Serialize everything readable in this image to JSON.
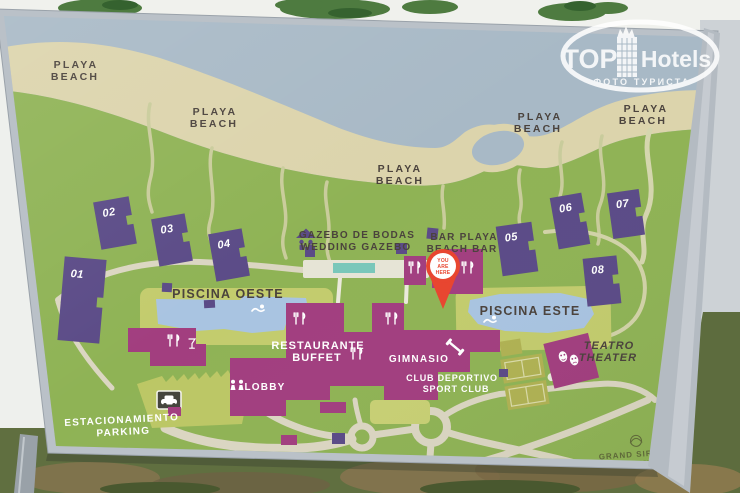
{
  "watermark": {
    "top_word": "TOP",
    "hotels_word": "Hotels",
    "subtitle": "ФОТО ТУРИСТА"
  },
  "brand": {
    "name": "GRAND SIRENIS",
    "tagline": "HOTELS & RESORTS",
    "stars": "★★★★★"
  },
  "map": {
    "beach_line1": "PLAYA",
    "beach_line2": "BEACH",
    "buildings": [
      "01",
      "02",
      "03",
      "04",
      "05",
      "06",
      "07",
      "08"
    ],
    "gazebo_line1": "GAZEBO DE BODAS",
    "gazebo_line2": "WEDDING GAZEBO",
    "bar_line1": "BAR PLAYA",
    "bar_line2": "BEACH BAR",
    "you_line1": "YOU",
    "you_line2": "ARE",
    "you_line3": "HERE",
    "piscina_oeste": "PISCINA OESTE",
    "piscina_este": "PISCINA ESTE",
    "restaurante_line1": "RESTAURANTE",
    "restaurante_line2": "BUFFET",
    "gimnasio": "GIMNASIO",
    "club_line1": "CLUB DEPORTIVO",
    "club_line2": "SPORT CLUB",
    "lobby": "LOBBY",
    "parking_line1": "ESTACIONAMIENTO",
    "parking_line2": "PARKING",
    "teatro_line1": "TEATRO",
    "teatro_line2": "THEATER",
    "colors": {
      "water": "#a8b9c6",
      "sand": "#dcd4ac",
      "land": "#8fb355",
      "pool_deck": "#c3cc6d",
      "pool": "#a9c4e1",
      "walkway_teal": "#79c7ba",
      "building_purple": "#5b4b87",
      "building_magenta": "#a23e7f",
      "road": "#dbd6c2",
      "pin_red": "#e8442e",
      "label_dark": "#4a423c",
      "label_white": "#ffffff"
    }
  }
}
